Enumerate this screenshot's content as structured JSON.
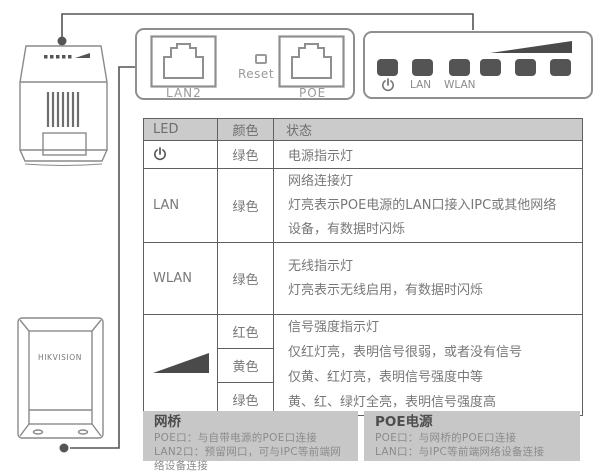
{
  "colors": {
    "led_square": "#545454",
    "signal_triangle": "#4a4a4a",
    "table_border": "#606060",
    "header_bg": "#cbcbcb",
    "info_box_bg": "#c7c7c7",
    "lineart_stroke": "#8a8a8a",
    "connector_stroke": "#555555"
  },
  "device": {
    "brand": "HIKVISION"
  },
  "port_panel": {
    "lan2_label": "LAN2",
    "reset_label": "Reset",
    "poe_label": "POE"
  },
  "led_panel": {
    "lan_label": "LAN",
    "wlan_label": "WLAN"
  },
  "table": {
    "headers": [
      "LED",
      "颜色",
      "状态"
    ],
    "rows": {
      "power": {
        "color": "绿色",
        "status": "电源指示灯"
      },
      "lan": {
        "label": "LAN",
        "color": "绿色",
        "status": [
          "网络连接灯",
          "灯亮表示POE电源的LAN口接入IPC或其他网络",
          "设备，有数据时闪烁"
        ]
      },
      "wlan": {
        "label": "WLAN",
        "color": "绿色",
        "status": [
          "无线指示灯",
          "灯亮表示无线启用，有数据时闪烁"
        ]
      },
      "signal": {
        "colors": [
          "红色",
          "黄色",
          "绿色"
        ],
        "status": [
          "信号强度指示灯",
          "仅红灯亮，表明信号很弱，或者没有信号",
          "仅黄、红灯亮，表明信号强度中等",
          "黄、红、绿灯全亮，表明信号强度高"
        ]
      }
    }
  },
  "info_boxes": {
    "bridge": {
      "title": "网桥",
      "lines": [
        "POE口：与自带电源的POE口连接",
        "LAN2口：预留网口，可与IPC等前端网络设备连接"
      ]
    },
    "poe_power": {
      "title": "POE电源",
      "lines": [
        "POE口：与网桥的POE口连接",
        "LAN口：与IPC等前端网络设备连接"
      ]
    }
  }
}
